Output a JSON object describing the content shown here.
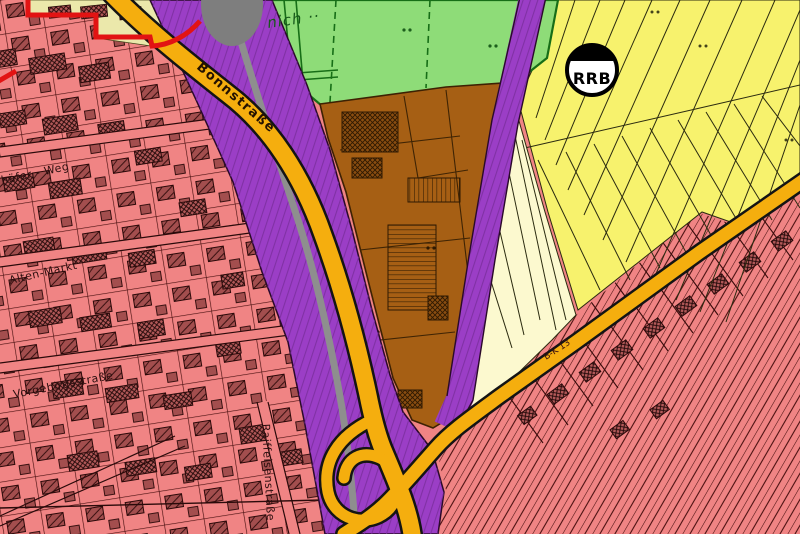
{
  "map": {
    "street_labels": {
      "bonnstrasse": "Bonnstraße",
      "vorgebirgsstrasse": "Vorgebirgsstraße",
      "raiffeisenstrasse": "Raiffeisenstraße",
      "alten_markt": "Alten-Markt",
      "schaefer_weg": "häfer - Weg"
    },
    "annotations": {
      "place_name_partial": "nich ··",
      "rrb_marker": "RRB",
      "plan_code": "B-K 13"
    },
    "legend_colors": {
      "residential_pink": "#f08484",
      "fields_yellow": "#f7f26d",
      "meadow_green": "#8edc78",
      "built_area_brown": "#a65f14",
      "corridor_purple": "#9b3ec6",
      "road_orange": "#f5ae0e",
      "rail_gray": "#8e8e8e",
      "plan_boundary_red": "#e21313",
      "pale_field_cream": "#fcf9cf",
      "plan_area_cream": "#ebe8ab",
      "marker_gray": "#7e7e7e"
    }
  }
}
